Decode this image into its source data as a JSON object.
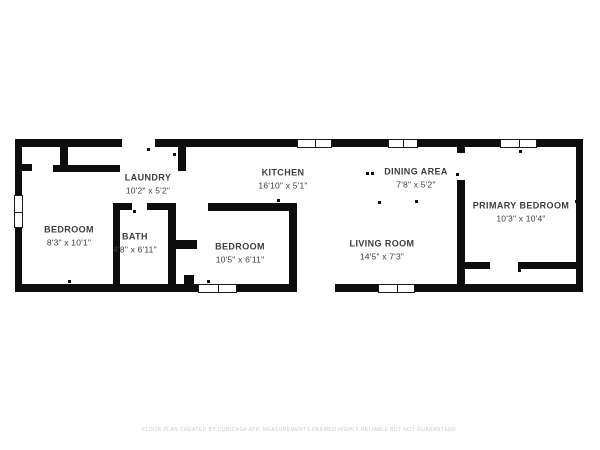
{
  "floor_plan": {
    "rooms": [
      {
        "name": "LAUNDRY",
        "dimensions": "10'2\" x 5'2\""
      },
      {
        "name": "KITCHEN",
        "dimensions": "16'10\" x 5'1\""
      },
      {
        "name": "DINING AREA",
        "dimensions": "7'8\" x 5'2\""
      },
      {
        "name": "PRIMARY BEDROOM",
        "dimensions": "10'3\" x 10'4\""
      },
      {
        "name": "BEDROOM",
        "dimensions": "8'3\" x 10'1\""
      },
      {
        "name": "BATH",
        "dimensions": "4'8\" x 6'11\""
      },
      {
        "name": "BEDROOM",
        "dimensions": "10'5\" x 6'11\""
      },
      {
        "name": "LIVING ROOM",
        "dimensions": "14'5\" x 7'3\""
      }
    ],
    "footer": {
      "text": "FLOOR PLAN CREATED BY CUBICASA APP. MEASUREMENTS DEEMED HIGHLY RELIABLE BUT NOT GUARANTEED."
    },
    "colors": {
      "wall": "#0d0d0d",
      "label_text": "#3d3d3d",
      "footer_text": "#c9c9c9",
      "background": "#ffffff"
    }
  }
}
